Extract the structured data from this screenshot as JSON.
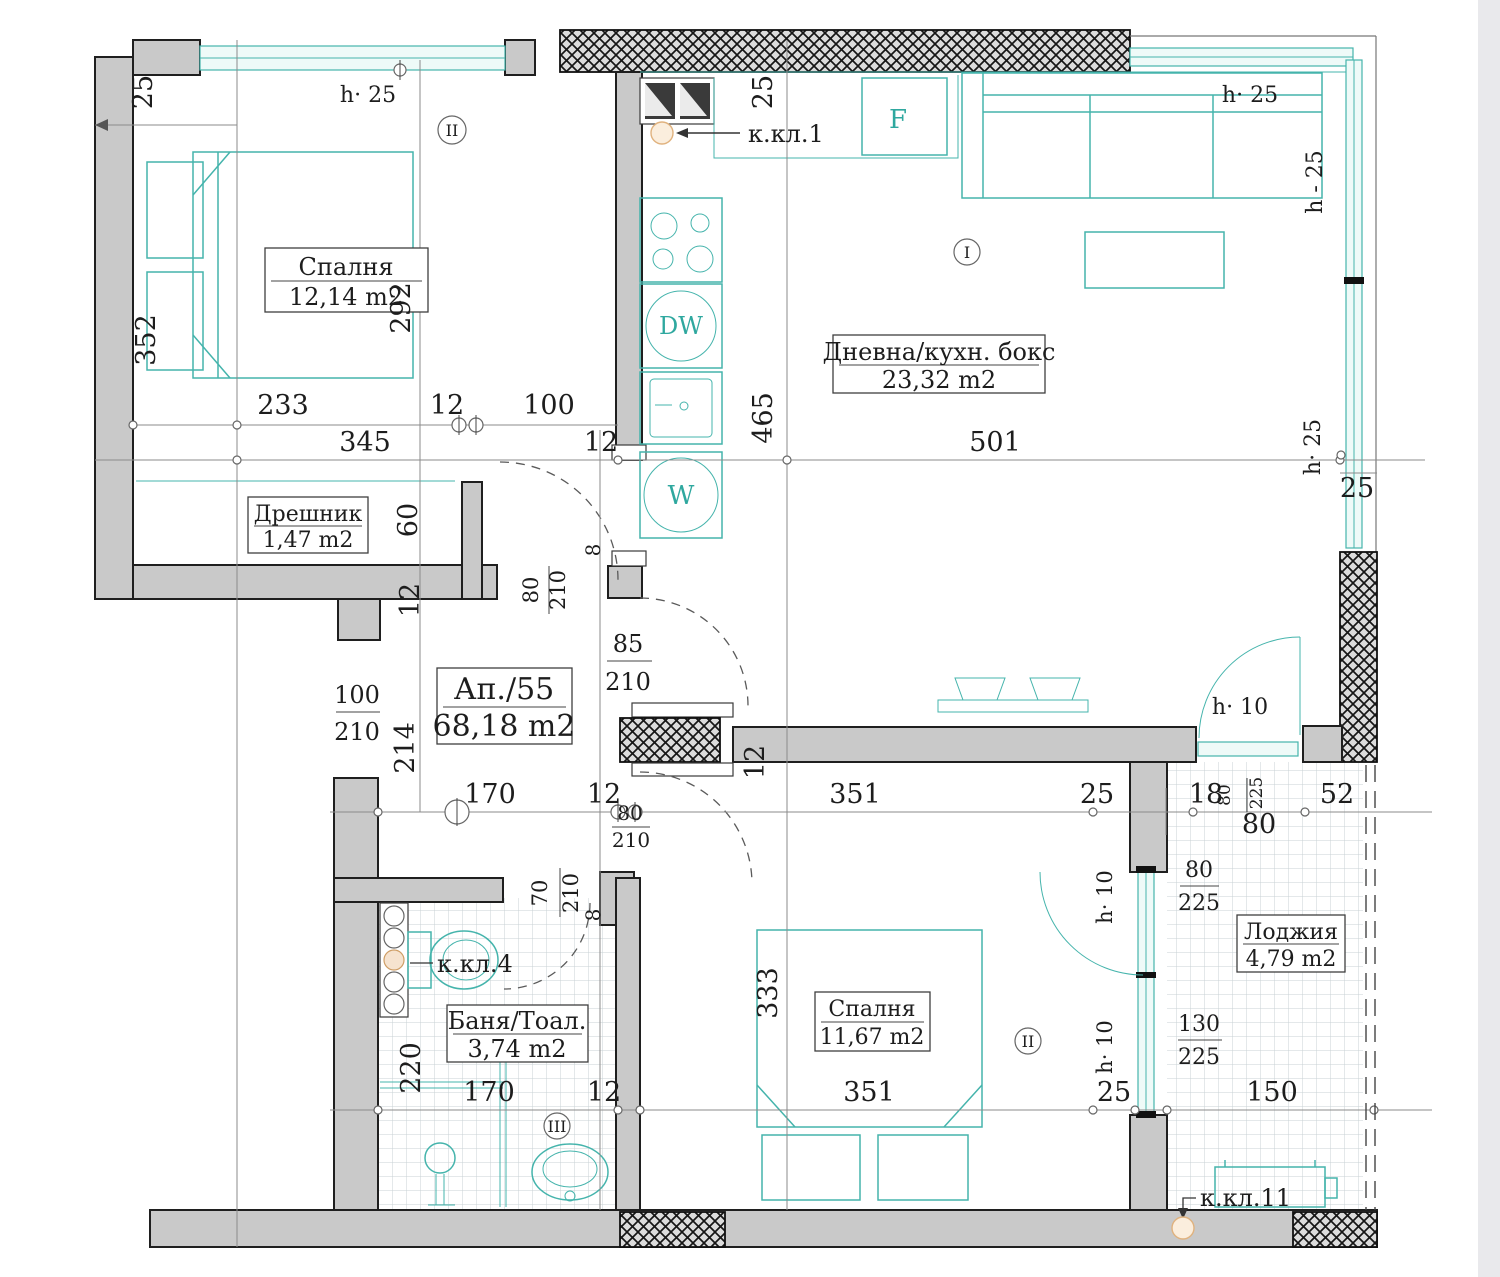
{
  "apartment": {
    "label": "Ап./55",
    "area": "68,18 m2"
  },
  "rooms": {
    "bedroom1": {
      "name": "Спалня",
      "area": "12,14 m2"
    },
    "living": {
      "name": "Дневна/кухн. бокс",
      "area": "23,32 m2"
    },
    "closet": {
      "name": "Дрешник",
      "area": "1,47 m2"
    },
    "bath": {
      "name": "Баня/Тоал.",
      "area": "3,74 m2"
    },
    "bedroom2": {
      "name": "Спалня",
      "area": "11,67 m2"
    },
    "loggia": {
      "name": "Лоджия",
      "area": "4,79 m2"
    }
  },
  "shafts": {
    "k1": "к.кл.1",
    "k4": "к.кл.4",
    "k11": "к.кл.11"
  },
  "appliances": {
    "fridge": "F",
    "dishwasher": "DW",
    "washer": "W"
  },
  "markers": {
    "mI": "I",
    "mIIa": "II",
    "mIIb": "II",
    "mIII": "III"
  },
  "heights": {
    "h25a": "h· 25",
    "h25b": "h· 25",
    "h25r1": "h - 25",
    "h25r2": "h· 25",
    "h10a": "h· 10",
    "h10b": "h· 10",
    "h10c": "h· 10"
  },
  "dims": {
    "v25tl": "25",
    "b1w": "233",
    "b1j": "12",
    "b1d": "100",
    "b1t": "345",
    "b1t2": "12",
    "b1h": "292",
    "b1s": "352",
    "k25": "25",
    "k465": "465",
    "liv501": "501",
    "livr25": "25",
    "c60": "60",
    "c12": "12",
    "c214": "214",
    "hall170": "170",
    "hall12": "12",
    "liv351": "351",
    "liv25": "25",
    "log18": "18",
    "log80s": "80",
    "log225s": "225",
    "log52": "52",
    "log80": "80",
    "b2_333": "333",
    "bath220": "220",
    "b170": "170",
    "b12": "12",
    "b351": "351",
    "b25": "25",
    "log150": "150",
    "wall12": "12",
    "j8a": "8",
    "j8b": "8"
  },
  "doors": {
    "bed1": {
      "n": "80",
      "d": "210"
    },
    "entry": {
      "n": "85",
      "d": "210"
    },
    "hall": {
      "n": "100",
      "d": "210"
    },
    "bed2": {
      "n": "80",
      "d": "210"
    },
    "bath": {
      "n": "70",
      "d": "210"
    },
    "logw1": {
      "n": "80",
      "d": "225"
    },
    "logw2": {
      "n": "130",
      "d": "225"
    }
  },
  "colors": {
    "teal": "#45b4ac",
    "wall": "#c9c9c9",
    "shaft_fill": "#fbeedd"
  }
}
